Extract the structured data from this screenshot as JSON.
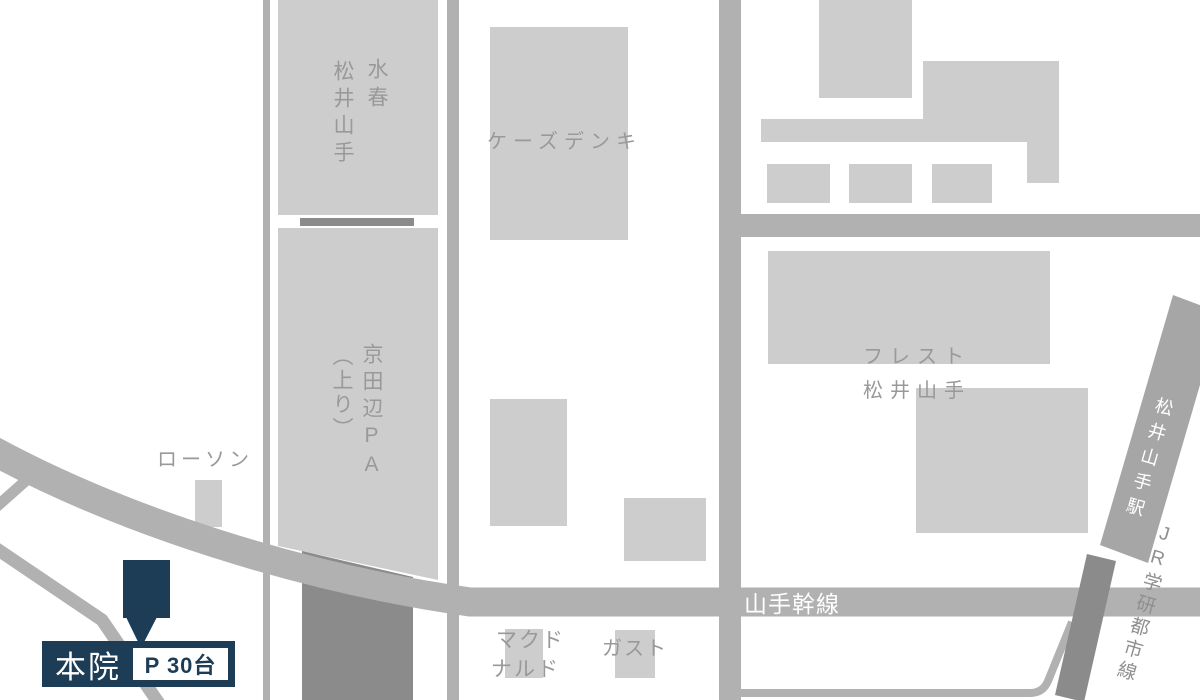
{
  "map": {
    "title_none": "",
    "colors": {
      "building": "#cdcdcd",
      "road": "#b1b1b1",
      "road_dark": "#8b8b8b",
      "station_band": "#a6a6a6",
      "label_gray": "#999999",
      "accent_navy": "#1d3c55",
      "label_on_road": "#ffffff"
    },
    "labels": {
      "suisyun_col1": "水春",
      "suisyun_col2": "松井山手",
      "ks_denki": "ケーズデンキ",
      "pa_col1": "京田辺PA",
      "pa_col2": "（上り）",
      "lawson": "ローソン",
      "frest_line1": "フレスト",
      "frest_line2": "松井山手",
      "mcdonalds_line1": "マクド",
      "mcdonalds_line2": "ナルド",
      "gusto": "ガスト",
      "yamate_trunk_road": "山手幹線",
      "station": "松井山手駅",
      "jr_gakkentoshi_line": "JR学研都市線",
      "main_clinic": "本院",
      "parking_capacity": "P 30台"
    }
  }
}
